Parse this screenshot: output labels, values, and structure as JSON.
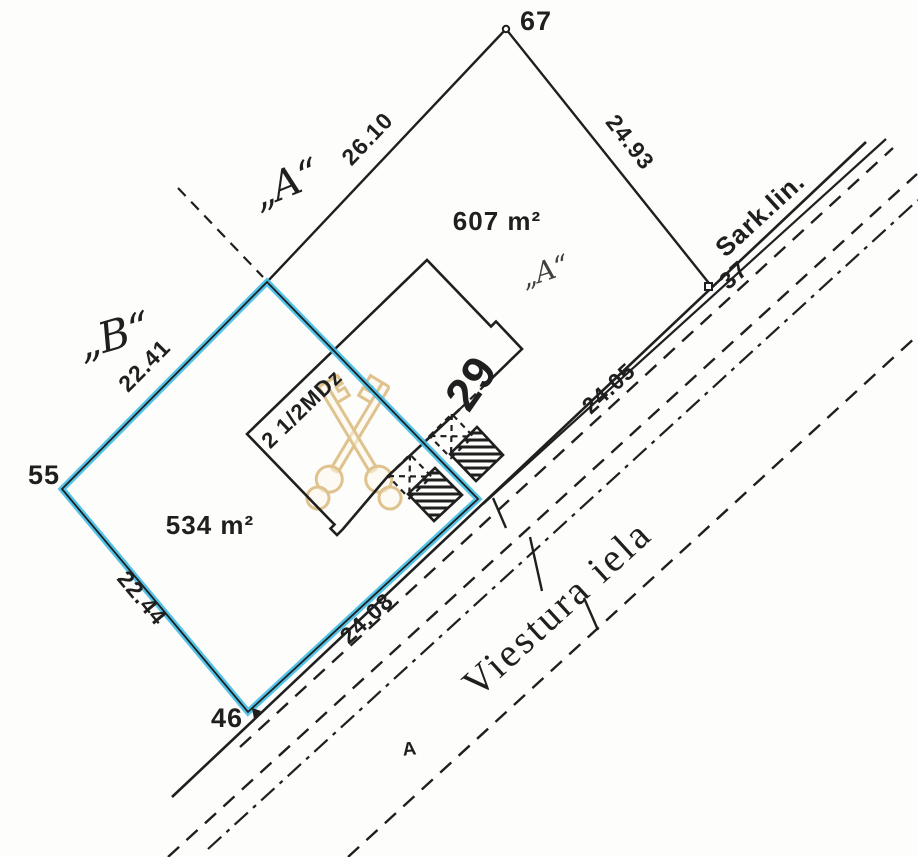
{
  "plan": {
    "paper_color": "#fdfdfb",
    "ink_color": "#1f1f1f",
    "highlight_color": "#41bce6",
    "watermark_color": "#ddbf85",
    "street": {
      "name": "Viestura iela",
      "red_line_label": "Sark.lin.",
      "arrow_marker": "A"
    },
    "points": {
      "p67": "67",
      "p55": "55",
      "p46": "46",
      "p37": "37"
    },
    "dimensions": {
      "d26_10": "26.10",
      "d24_93": "24.93",
      "d24_05": "24.05",
      "d22_41": "22.41",
      "d22_44": "22.44",
      "d24_08": "24.08"
    },
    "areas": {
      "plot_a": "607 m²",
      "plot_b": "534 m²"
    },
    "boundary_labels": {
      "a": "„A“",
      "b": "„B“",
      "a_small": "„A“"
    },
    "building": {
      "type_label": "2 1/2MDz",
      "house_number": "29"
    }
  }
}
